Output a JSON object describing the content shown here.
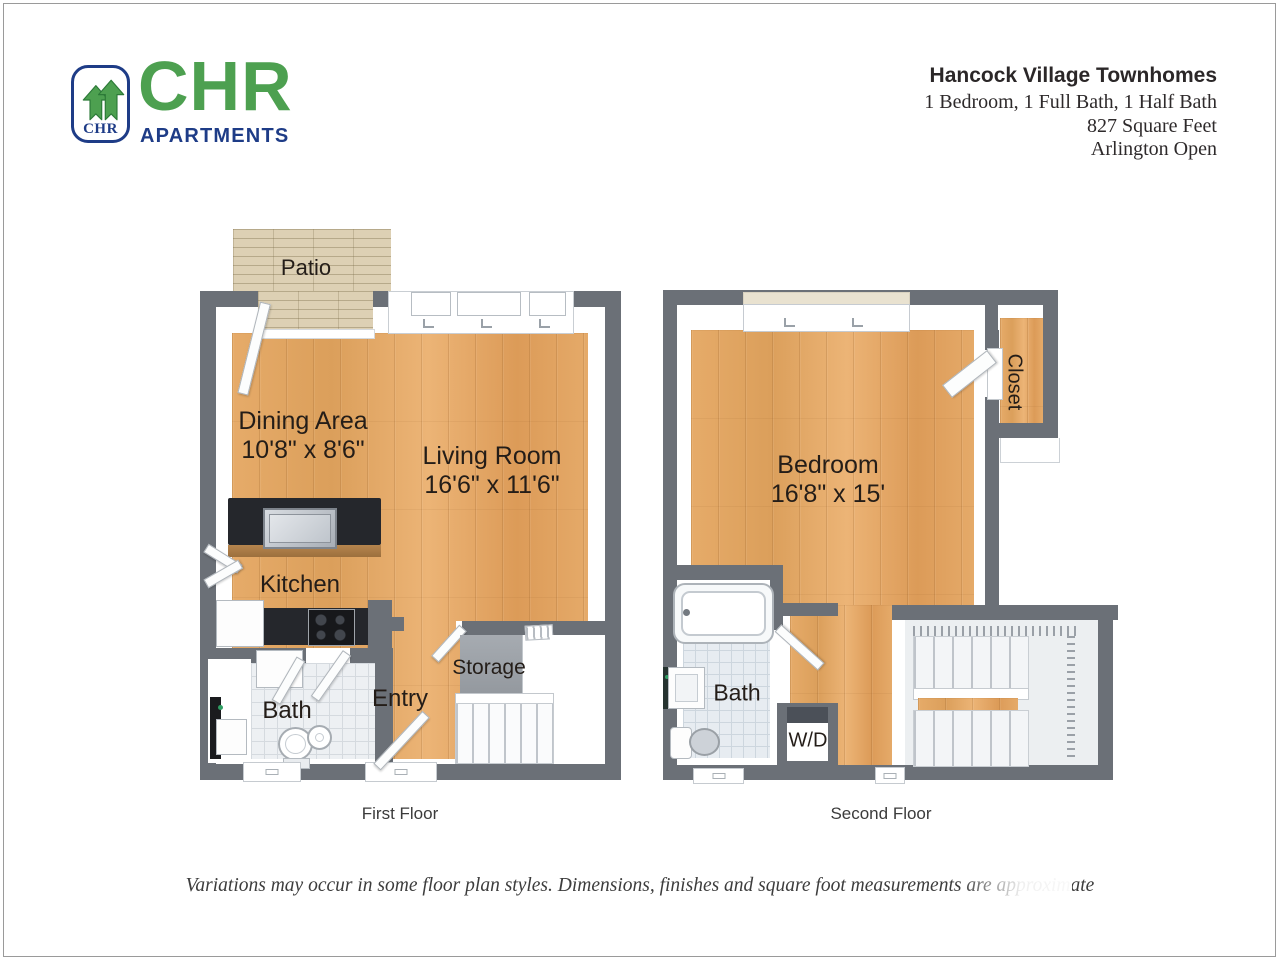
{
  "header": {
    "logo": {
      "brand": "CHR",
      "brand_sub": "APARTMENTS",
      "monogram": "CHR"
    },
    "property": {
      "name": "Hancock Village Townhomes",
      "details": [
        "1 Bedroom, 1 Full Bath, 1 Half Bath",
        "827 Square Feet",
        "Arlington Open"
      ]
    }
  },
  "floors": {
    "first": {
      "caption": "First Floor",
      "rooms": {
        "patio": "Patio",
        "dining": {
          "name": "Dining Area",
          "dims": "10'8\" x 8'6\""
        },
        "living": {
          "name": "Living Room",
          "dims": "16'6\" x 11'6\""
        },
        "kitchen": "Kitchen",
        "bath": "Bath",
        "entry": "Entry",
        "storage": "Storage"
      }
    },
    "second": {
      "caption": "Second Floor",
      "rooms": {
        "bedroom": {
          "name": "Bedroom",
          "dims": "16'8\" x 15'"
        },
        "closet": "Closet",
        "bath": "Bath",
        "laundry": "W/D"
      }
    }
  },
  "footer": {
    "disclaimer": "Variations may occur in some floor plan styles. Dimensions, finishes and square foot measurements are approximate"
  },
  "colors": {
    "wall": "#6b7077",
    "wood_floor": "#e2a263",
    "patio": "#ddd0b4",
    "tile": "#edf0f3",
    "counter": "#25272c",
    "logo_green": "#4da050",
    "logo_blue": "#1e3c87"
  }
}
